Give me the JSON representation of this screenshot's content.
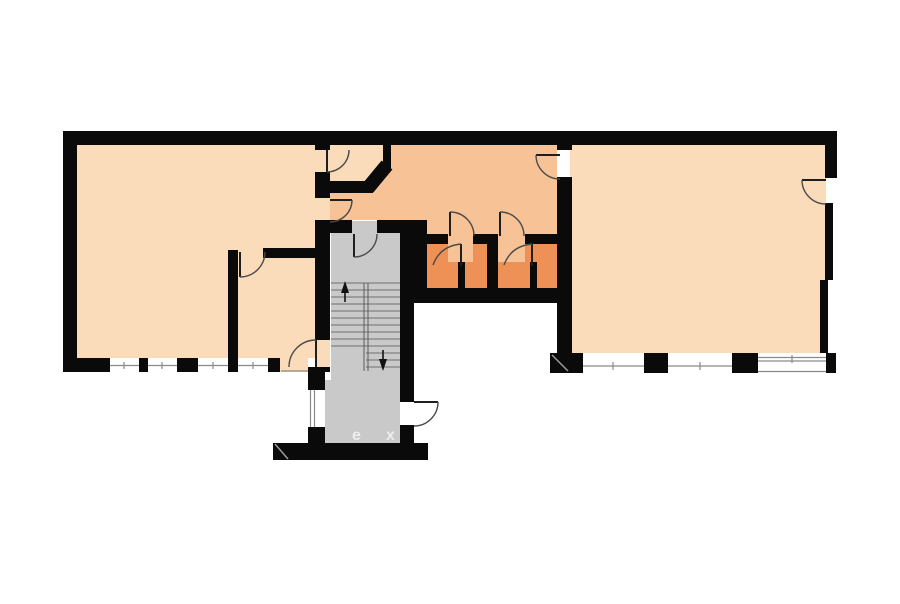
{
  "title": "building-floor-plan",
  "colors": {
    "background": "#ffffff",
    "wall": "#0a0a0a",
    "room": "#fbdcba",
    "corridor": "#f7c296",
    "wet": "#ee9156",
    "stair": "#c9c9c9",
    "label": "#ededed",
    "line": "#4a4a4a",
    "window": "#8a8a8a"
  },
  "stairwell": {
    "label_left": "e",
    "label_right": "x"
  },
  "icons": {
    "up": "stair-up-arrow",
    "down": "stair-down-arrow"
  },
  "rooms": [
    {
      "id": "room-left",
      "fill": "room"
    },
    {
      "id": "room-left-sub",
      "fill": "room"
    },
    {
      "id": "closet",
      "fill": "room"
    },
    {
      "id": "corridor",
      "fill": "corridor"
    },
    {
      "id": "wc-1",
      "fill": "wet"
    },
    {
      "id": "wc-2",
      "fill": "wet"
    },
    {
      "id": "stairwell",
      "fill": "stair"
    },
    {
      "id": "room-right",
      "fill": "room"
    }
  ]
}
